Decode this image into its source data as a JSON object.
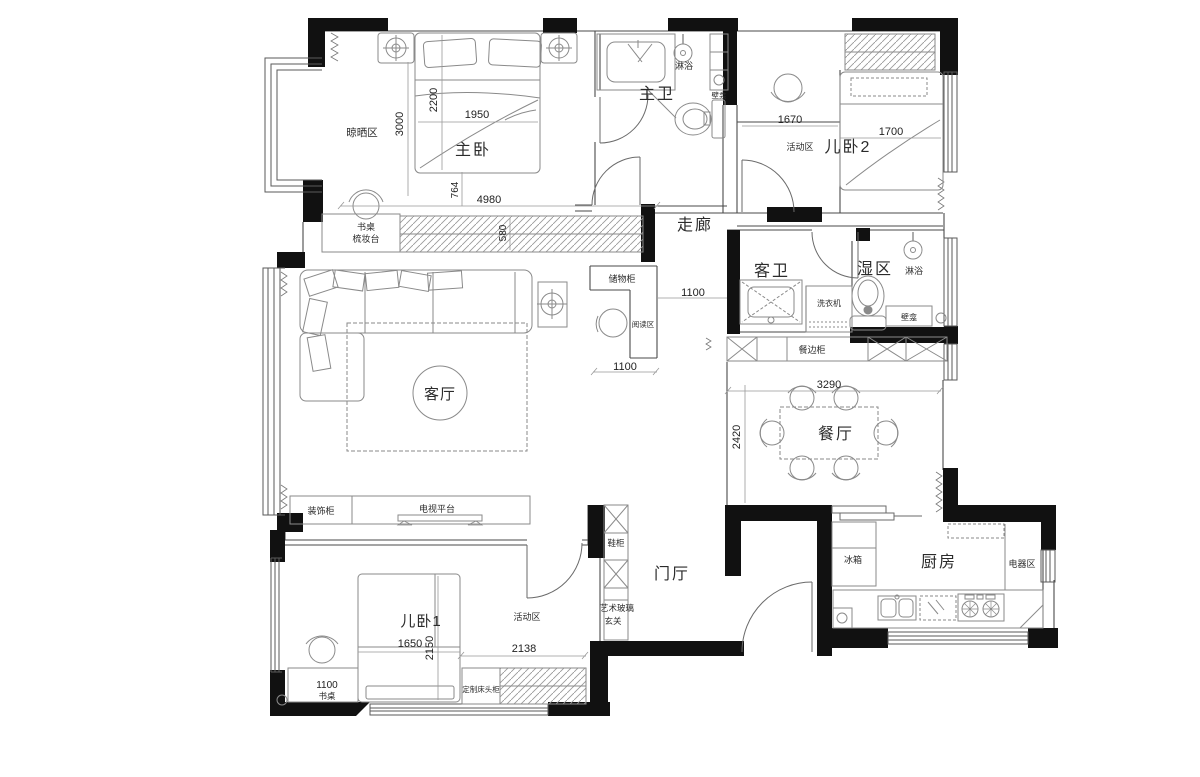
{
  "plan_type": "apartment-floor-plan",
  "colors": {
    "wall": "#111111",
    "structure": "#555555",
    "furniture": "#8a8a8a",
    "dimension": "#444444",
    "text": "#2b2b2b",
    "background": "#ffffff"
  },
  "rooms": {
    "drying_area": "晾晒区",
    "master_bedroom": "主卧",
    "master_bath": "主卫",
    "kids_bedroom_2": "儿卧2",
    "activity_area_2": "活动区",
    "corridor": "走廊",
    "guest_bath": "客卫",
    "wet_area": "湿区",
    "living_room": "客厅",
    "dining_room": "餐厅",
    "entry_hall": "门厅",
    "kitchen": "厨房",
    "kids_bedroom_1": "儿卧1",
    "activity_area_1": "活动区"
  },
  "furniture": {
    "desk_dresser_line1": "书桌",
    "desk_dresser_line2": "梳妆台",
    "shower_master": "淋浴",
    "niche_master": "壁龛",
    "storage_cabinet": "储物柜",
    "reading_area": "阅读区",
    "washing_machine": "洗衣机",
    "shower_wet": "淋浴",
    "niche_wet": "壁龛",
    "sideboard": "餐边柜",
    "decor_cabinet": "装饰柜",
    "tv_platform": "电视平台",
    "shoe_cabinet": "鞋柜",
    "art_glass_line1": "艺术玻璃",
    "art_glass_line2": "玄关",
    "fridge": "冰箱",
    "appliance_area": "电器区",
    "desk_1": "书桌",
    "custom_bedside": "定制床头柜"
  },
  "dimensions": {
    "d2200": "2200",
    "d1950": "1950",
    "d3000": "3000",
    "d764": "764",
    "d4980": "4980",
    "d580": "580",
    "d1670": "1670",
    "d1700": "1700",
    "d1100_corridor": "1100",
    "d1100_storage": "1100",
    "d3290": "3290",
    "d2420": "2420",
    "d1650": "1650",
    "d2150": "2150",
    "d2138": "2138",
    "d1100_desk": "1100"
  }
}
